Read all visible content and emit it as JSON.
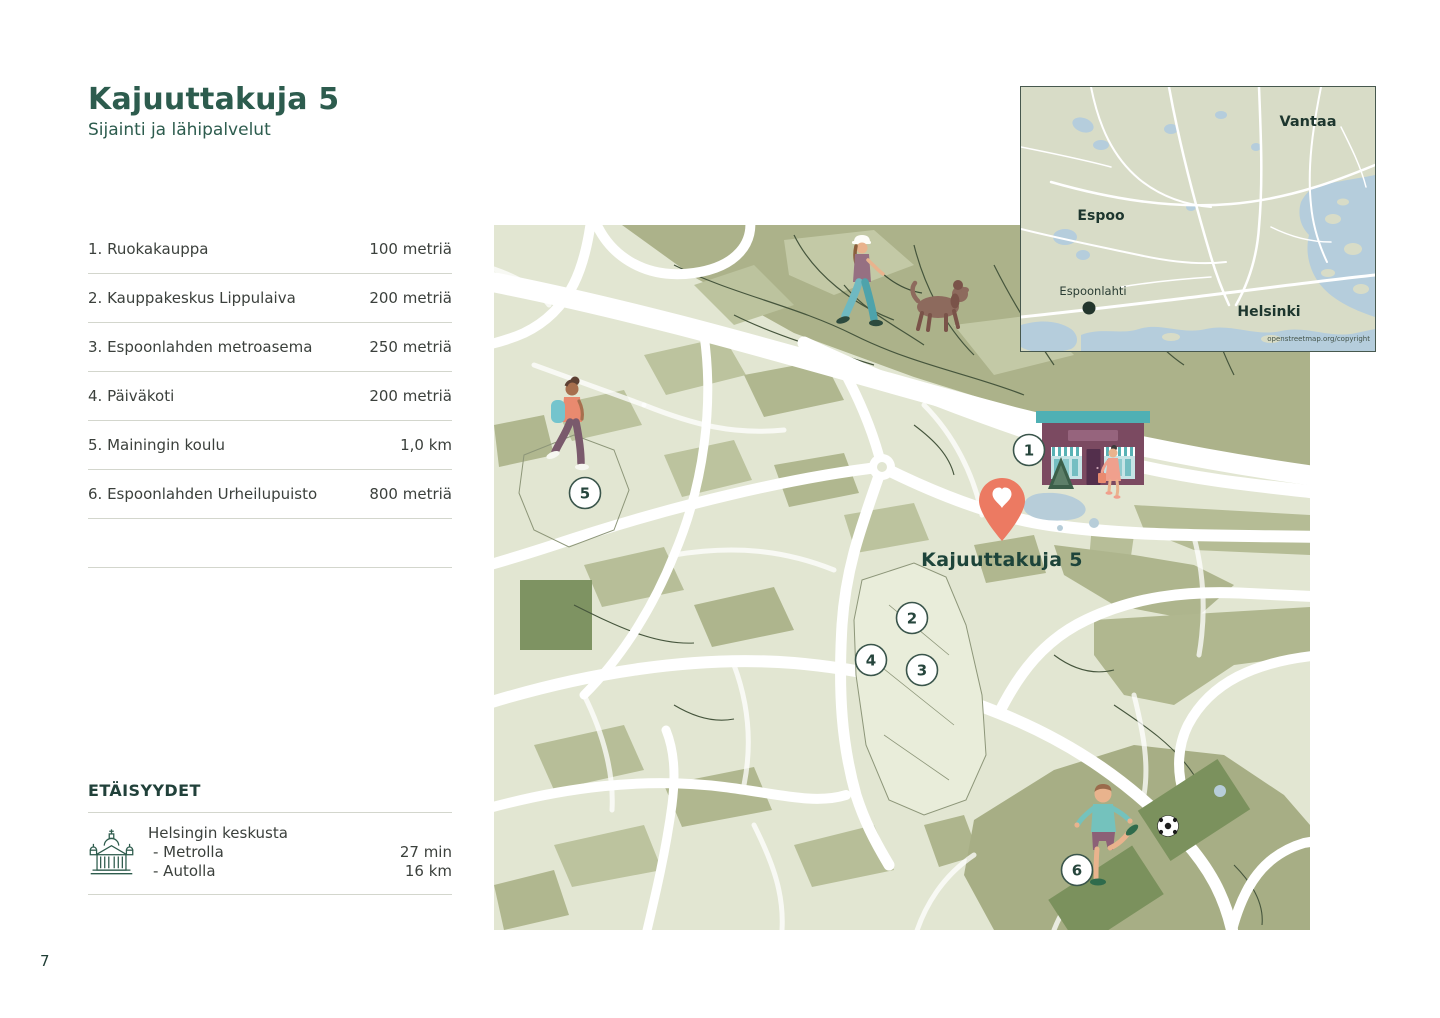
{
  "header": {
    "title": "Kajuuttakuja 5",
    "subtitle": "Sijainti ja lähipalvelut"
  },
  "services": {
    "items": [
      {
        "label": "1. Ruokakauppa",
        "distance": "100 metriä"
      },
      {
        "label": "2. Kauppakeskus Lippulaiva",
        "distance": "200 metriä"
      },
      {
        "label": "3. Espoonlahden metroasema",
        "distance": "250 metriä"
      },
      {
        "label": "4. Päiväkoti",
        "distance": "200 metriä"
      },
      {
        "label": "5. Mainingin koulu",
        "distance": "1,0 km"
      },
      {
        "label": "6. Espoonlahden Urheilupuisto",
        "distance": "800 metriä"
      }
    ]
  },
  "distances": {
    "heading": "ETÄISYYDET",
    "icon": "helsinki-cathedral-icon",
    "destination": "Helsingin keskusta",
    "rows": [
      {
        "mode": "- Metrolla",
        "value": "27 min"
      },
      {
        "mode": "- Autolla",
        "value": "16 km"
      }
    ]
  },
  "footer": {
    "page_number": "7"
  },
  "map": {
    "pin_label": "Kajuuttakuja 5",
    "pin_icon": "heart-location-pin",
    "markers": [
      "1",
      "2",
      "3",
      "4",
      "5",
      "6"
    ]
  },
  "inset": {
    "labels": {
      "vantaa": "Vantaa",
      "espoo": "Espoo",
      "espoonlahti": "Espoonlahti",
      "helsinki": "Helsinki"
    },
    "copyright": "openstreetmap.org/copyright"
  },
  "colors": {
    "accent_green": "#2D5C4E",
    "text_dark": "#3B403C",
    "pin_coral": "#EC7A62",
    "map_base": "#E2E6D2",
    "map_forest": "#ACB28A",
    "map_water": "#B7CDD9",
    "pitch_green": "#7B915D"
  }
}
